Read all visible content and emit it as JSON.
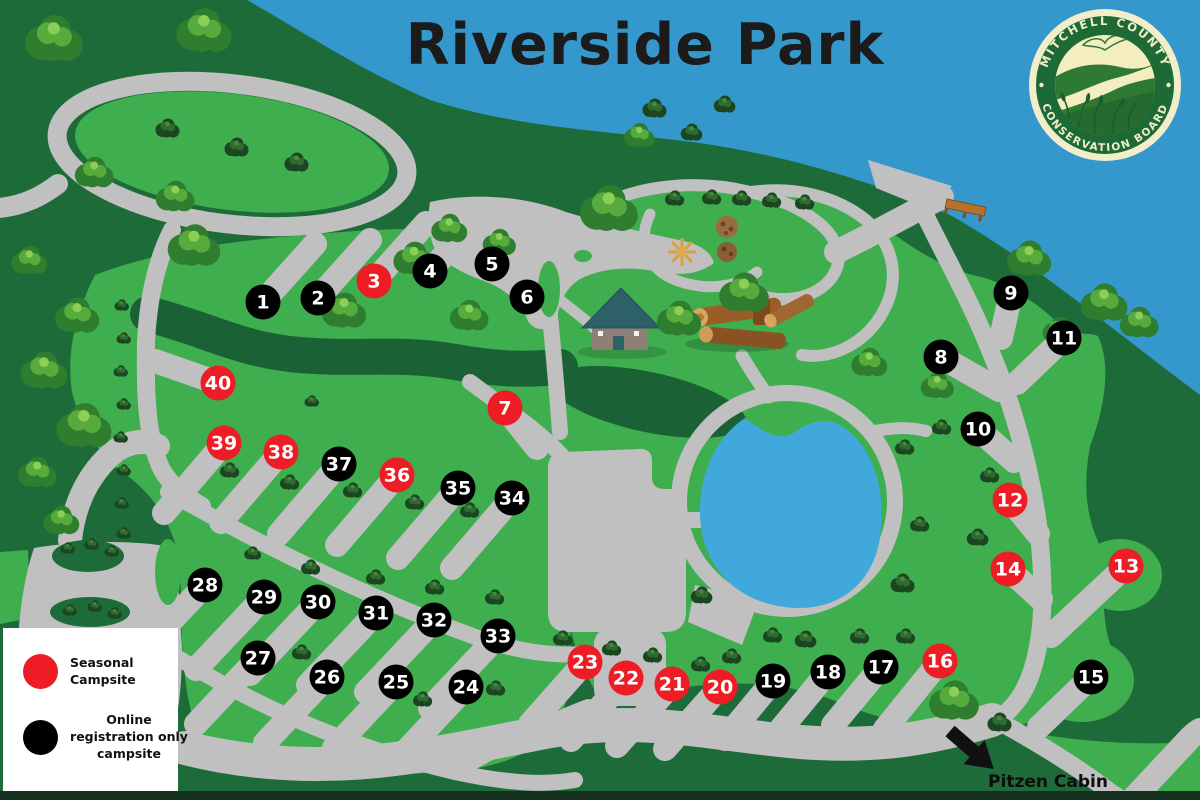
{
  "title": "Riverside Park",
  "logo": {
    "top_text": "MITCHELL COUNTY",
    "bottom_text": "CONSERVATION BOARD"
  },
  "legend": {
    "items": [
      {
        "key": "seasonal",
        "label": "Seasonal Campsite",
        "color": "#ee1c25"
      },
      {
        "key": "online",
        "label": "Online registration only campsite",
        "color": "#000000"
      }
    ]
  },
  "map": {
    "pitzen_label": "Pitzen Cabin",
    "campsites": [
      {
        "n": 1,
        "x": 263,
        "y": 302,
        "type": "online"
      },
      {
        "n": 2,
        "x": 318,
        "y": 298,
        "type": "online"
      },
      {
        "n": 3,
        "x": 374,
        "y": 281,
        "type": "seasonal"
      },
      {
        "n": 4,
        "x": 430,
        "y": 271,
        "type": "online"
      },
      {
        "n": 5,
        "x": 492,
        "y": 264,
        "type": "online"
      },
      {
        "n": 6,
        "x": 527,
        "y": 297,
        "type": "online"
      },
      {
        "n": 7,
        "x": 505,
        "y": 408,
        "type": "seasonal"
      },
      {
        "n": 8,
        "x": 941,
        "y": 357,
        "type": "online"
      },
      {
        "n": 9,
        "x": 1011,
        "y": 293,
        "type": "online"
      },
      {
        "n": 10,
        "x": 978,
        "y": 429,
        "type": "online"
      },
      {
        "n": 11,
        "x": 1064,
        "y": 338,
        "type": "online"
      },
      {
        "n": 12,
        "x": 1010,
        "y": 500,
        "type": "seasonal"
      },
      {
        "n": 13,
        "x": 1126,
        "y": 566,
        "type": "seasonal"
      },
      {
        "n": 14,
        "x": 1008,
        "y": 569,
        "type": "seasonal"
      },
      {
        "n": 15,
        "x": 1091,
        "y": 677,
        "type": "online"
      },
      {
        "n": 16,
        "x": 940,
        "y": 661,
        "type": "seasonal"
      },
      {
        "n": 17,
        "x": 881,
        "y": 667,
        "type": "online"
      },
      {
        "n": 18,
        "x": 828,
        "y": 672,
        "type": "online"
      },
      {
        "n": 19,
        "x": 773,
        "y": 681,
        "type": "online"
      },
      {
        "n": 20,
        "x": 720,
        "y": 687,
        "type": "seasonal"
      },
      {
        "n": 21,
        "x": 672,
        "y": 684,
        "type": "seasonal"
      },
      {
        "n": 22,
        "x": 626,
        "y": 678,
        "type": "seasonal"
      },
      {
        "n": 23,
        "x": 585,
        "y": 662,
        "type": "seasonal"
      },
      {
        "n": 24,
        "x": 466,
        "y": 687,
        "type": "online"
      },
      {
        "n": 25,
        "x": 396,
        "y": 682,
        "type": "online"
      },
      {
        "n": 26,
        "x": 327,
        "y": 677,
        "type": "online"
      },
      {
        "n": 27,
        "x": 258,
        "y": 658,
        "type": "online"
      },
      {
        "n": 28,
        "x": 205,
        "y": 585,
        "type": "online"
      },
      {
        "n": 29,
        "x": 264,
        "y": 597,
        "type": "online"
      },
      {
        "n": 30,
        "x": 318,
        "y": 602,
        "type": "online"
      },
      {
        "n": 31,
        "x": 376,
        "y": 613,
        "type": "online"
      },
      {
        "n": 32,
        "x": 434,
        "y": 620,
        "type": "online"
      },
      {
        "n": 33,
        "x": 498,
        "y": 636,
        "type": "online"
      },
      {
        "n": 34,
        "x": 512,
        "y": 498,
        "type": "online"
      },
      {
        "n": 35,
        "x": 458,
        "y": 488,
        "type": "online"
      },
      {
        "n": 36,
        "x": 397,
        "y": 475,
        "type": "seasonal"
      },
      {
        "n": 37,
        "x": 339,
        "y": 464,
        "type": "online"
      },
      {
        "n": 38,
        "x": 281,
        "y": 452,
        "type": "seasonal"
      },
      {
        "n": 39,
        "x": 224,
        "y": 443,
        "type": "seasonal"
      },
      {
        "n": 40,
        "x": 218,
        "y": 383,
        "type": "seasonal"
      }
    ]
  },
  "colors": {
    "river": "#3598cd",
    "pond": "#41a8dc",
    "grass": "#3fae4e",
    "dark_green": "#1d6b39",
    "darker_green": "#1a6136",
    "road": "#bfc0bf",
    "seasonal": "#ee1c25",
    "online": "#000000",
    "marker_text": "#ffffff",
    "legend_bg": "#ffffff",
    "logo_green": "#1d6a37",
    "logo_cream": "#f2eec9"
  }
}
